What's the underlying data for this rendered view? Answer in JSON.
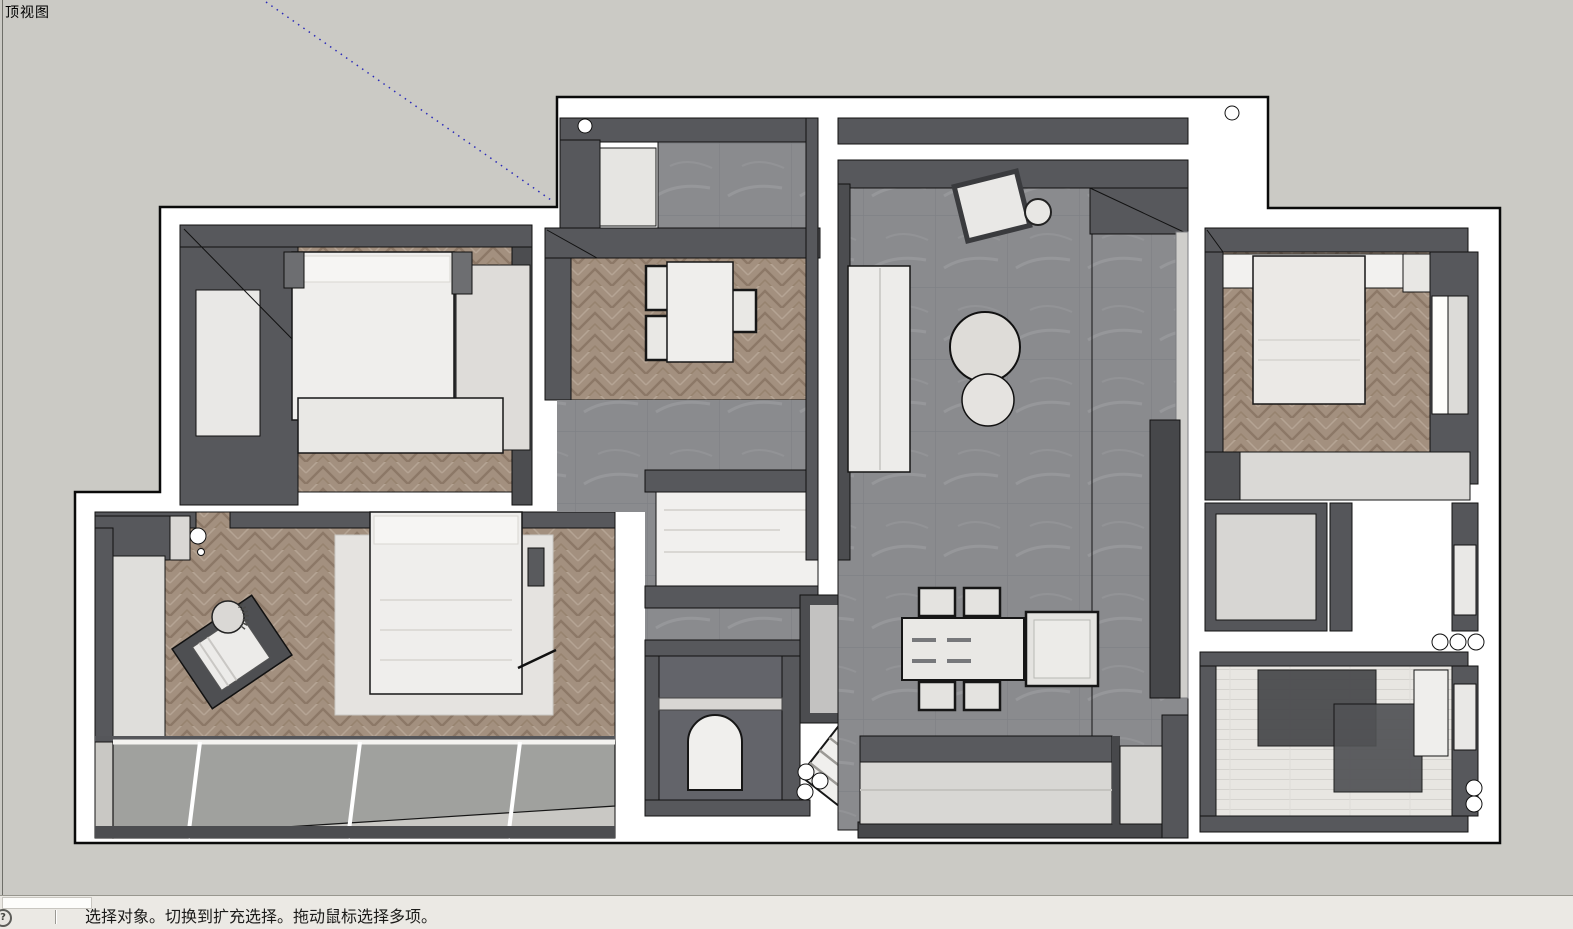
{
  "viewport": {
    "view_label": "顶视图",
    "background_color": "#cbcac5",
    "guide_line_color": "#2a2ab8"
  },
  "statusbar": {
    "help_icon": "circled-question-icon",
    "help_glyph": "?",
    "message": "选择对象。切换到扩充选择。拖动鼠标选择多项。",
    "measurement_value": ""
  },
  "floorplan": {
    "colors": {
      "exterior_wall": "#ffffff",
      "interior_wall": "#57585c",
      "interior_wall_dark": "#3f4043",
      "tile_floor": "#8a8b8e",
      "wood_floor": "#a3907f",
      "furniture_light": "#eceae7",
      "glass": "#8e8f90",
      "outline": "#111111"
    },
    "regions": [
      "entry-hall",
      "study-room",
      "corridor",
      "living-room",
      "dining-area",
      "kitchen",
      "bedroom-top-left",
      "bedroom-bottom-left",
      "balcony",
      "bedroom-top-right",
      "vanity-room",
      "bathroom-middle",
      "shower-room-bottom-right"
    ]
  }
}
